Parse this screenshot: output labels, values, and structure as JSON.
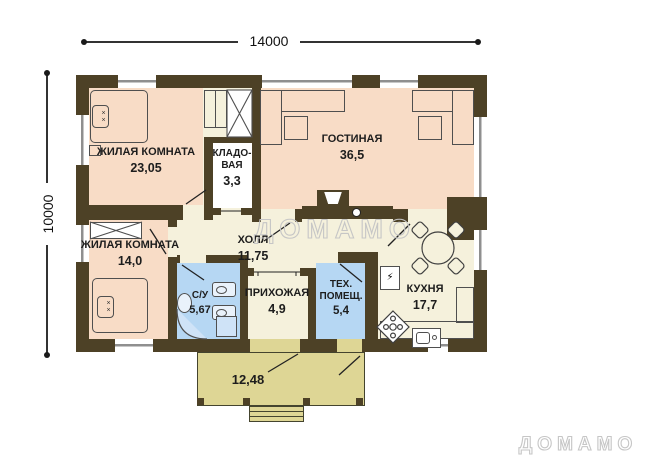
{
  "colors": {
    "wall": "#4d4126",
    "room-warm": "#f8dcc6",
    "room-neutral": "#f5f1dc",
    "room-wet": "#b6d7f3",
    "terrace": "#ded695",
    "watermark": "#c6c6c6"
  },
  "dimensions": {
    "width": "14000",
    "height": "10000"
  },
  "watermark": {
    "center": "ДОМАМО",
    "corner": "ДОМАМО"
  },
  "rooms": {
    "bedroom1": {
      "name": "ЖИЛАЯ КОМНАТА",
      "area": "23,05"
    },
    "storage": {
      "name": "КЛАДО-ВАЯ",
      "area": "3,3"
    },
    "living": {
      "name": "ГОСТИНАЯ",
      "area": "36,5"
    },
    "bedroom2": {
      "name": "ЖИЛАЯ КОМНАТА",
      "area": "14,0"
    },
    "hall": {
      "name": "ХОЛЛ",
      "area": "11,75"
    },
    "bathroom": {
      "name": "С/У",
      "area": "5,67"
    },
    "entry": {
      "name": "ПРИХОЖАЯ",
      "area": "4,9"
    },
    "utility": {
      "name": "ТЕХ. ПОМЕЩ.",
      "area": "5,4"
    },
    "kitchen": {
      "name": "КУХНЯ",
      "area": "17,7"
    },
    "terrace": {
      "area": "12,48"
    }
  },
  "icons": {
    "pillow_marks": "××",
    "boiler_bolt": "⚡"
  }
}
